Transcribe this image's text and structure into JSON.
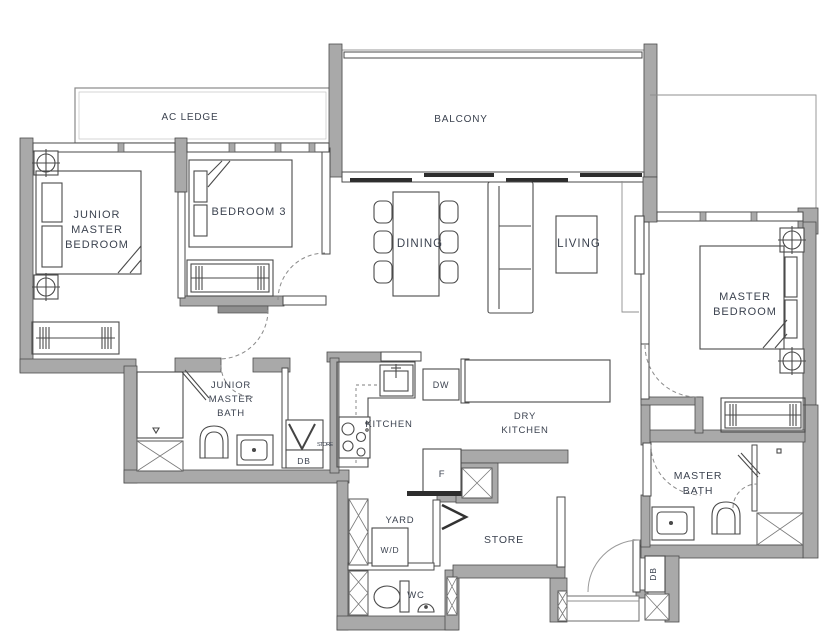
{
  "plan": {
    "rooms": {
      "ac_ledge": {
        "label": "AC LEDGE"
      },
      "balcony": {
        "label": "BALCONY"
      },
      "junior_master_bedroom": {
        "lines": [
          "JUNIOR",
          "MASTER",
          "BEDROOM"
        ]
      },
      "bedroom_3": {
        "label": "BEDROOM 3"
      },
      "dining": {
        "label": "DINING"
      },
      "living": {
        "label": "LIVING"
      },
      "master_bedroom": {
        "lines": [
          "MASTER",
          "BEDROOM"
        ]
      },
      "junior_master_bath": {
        "lines": [
          "JUNIOR",
          "MASTER",
          "BATH"
        ]
      },
      "kitchen": {
        "label": "KITCHEN"
      },
      "dry_kitchen": {
        "lines": [
          "DRY",
          "KITCHEN"
        ]
      },
      "master_bath": {
        "lines": [
          "MASTER",
          "BATH"
        ]
      },
      "yard": {
        "label": "YARD"
      },
      "wc": {
        "label": "WC"
      },
      "store": {
        "label": "STORE"
      },
      "hall_store_closet": {
        "label": "STORE"
      }
    },
    "labels": {
      "dishwasher": "DW",
      "fridge": "F",
      "washer_dryer": "W/D",
      "db_hall": "DB",
      "db_entry": "DB"
    },
    "colors": {
      "wall_fill": "#a9a9a9",
      "wall_edge": "#4c4c4c",
      "line": "#4a4a4a",
      "text": "#3c4350",
      "background": "#ffffff"
    }
  }
}
